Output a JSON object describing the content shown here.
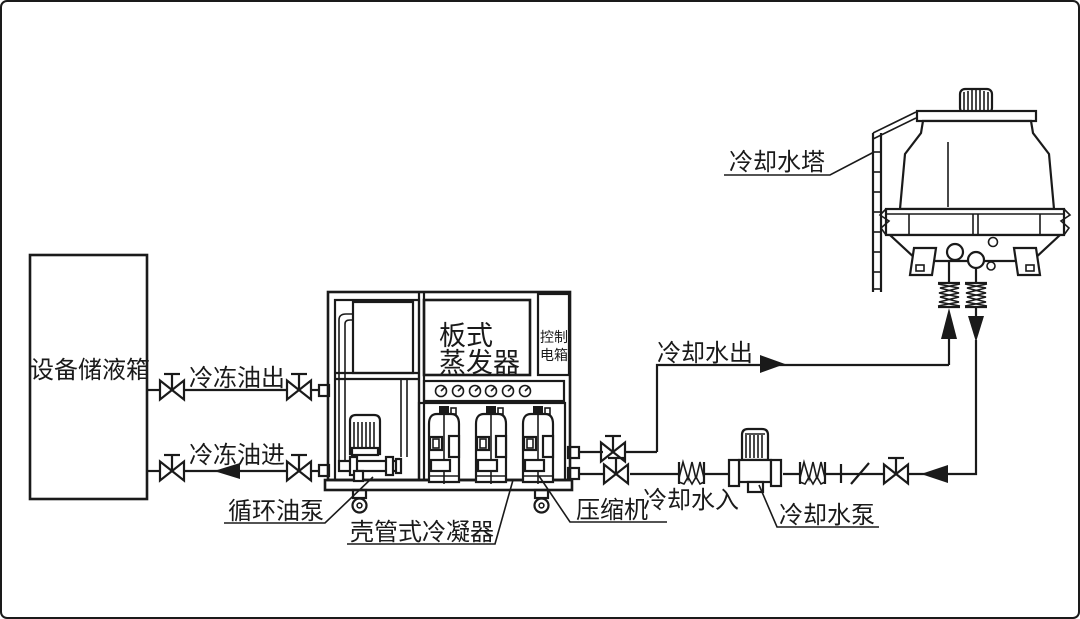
{
  "diagram": {
    "type": "chiller-cooling-system-piping-diagram",
    "labels": {
      "storage_tank": "设备储液箱",
      "oil_out": "冷冻油出",
      "oil_in": "冷冻油进",
      "plate_evaporator": [
        "板式",
        "蒸发器"
      ],
      "control_box": [
        "控制",
        "电箱"
      ],
      "cooling_tower": "冷却水塔",
      "cooling_water_out": "冷却水出",
      "cooling_water_in": "冷却水入",
      "circulating_oil_pump": "循环油泵",
      "shell_tube_condenser": "壳管式冷凝器",
      "compressor": "压缩机",
      "cooling_water_pump": "冷却水泵"
    },
    "colors": {
      "line": "#1a1a1a",
      "background": "#ffffff"
    }
  }
}
